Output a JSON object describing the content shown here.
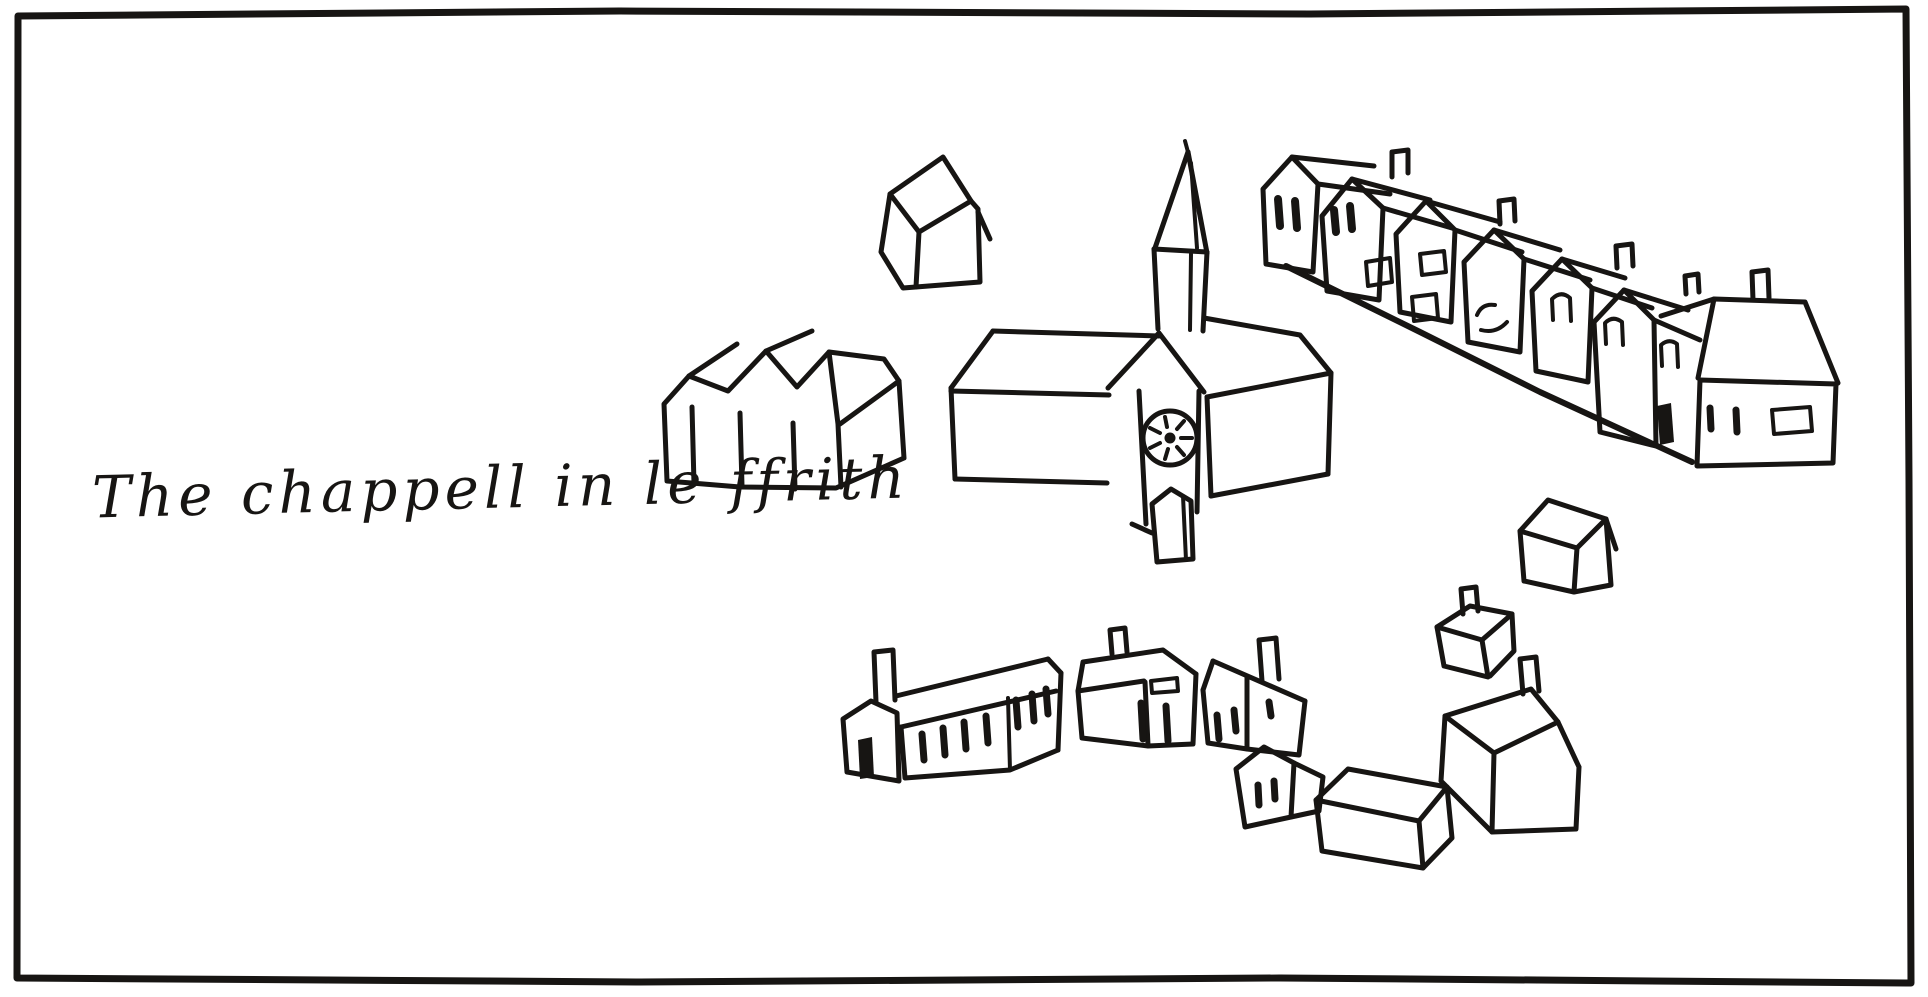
{
  "figure": {
    "title": "Hand-drawn village sketch from an Elizabethan survey map",
    "caption": {
      "transcription": "The chappell in le ffrith",
      "script": "secretary hand"
    },
    "palette": {
      "ink": "#171513",
      "paper": "#ffffff"
    },
    "scene": {
      "elements": [
        "border-frame",
        "handwritten-caption",
        "detached-house-north",
        "triple-gabled-building",
        "chapel-nave",
        "chapel-clock-tower",
        "chapel-spire",
        "chapel-chancel",
        "chapel-porch-hut",
        "street-row-of-gabled-houses",
        "street-row-end-house",
        "cube-house",
        "small-house-with-chimney",
        "large-house-with-chimney",
        "barn-house",
        "lane-house-with-chimney-1",
        "lane-house-with-chimney-2",
        "lane-house-small",
        "longhouse-with-chimney-and-door"
      ]
    }
  }
}
